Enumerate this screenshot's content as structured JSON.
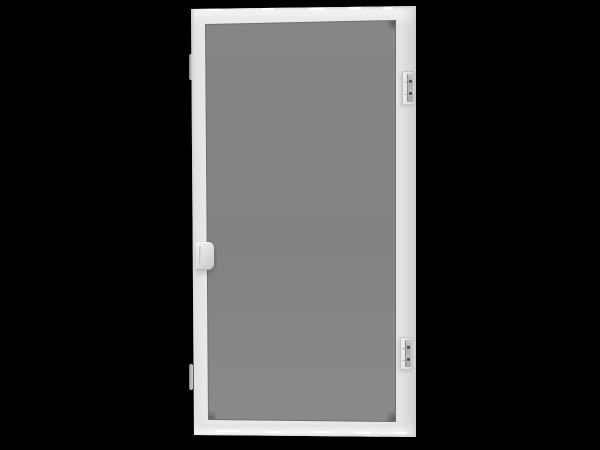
{
  "scene": {
    "type": "product-photo",
    "background_color": "#000000",
    "product": {
      "name": "White frame window screen with gray mesh",
      "frame_color": "#ececec",
      "frame_shadow_color": "#cccccc",
      "mesh_color": "#858585",
      "mesh_groove_color": "#6f6f6f",
      "hardware_color": "#dedede",
      "screw_color": "#4c4c4c",
      "parts": {
        "frame": "extruded screen frame",
        "mesh": "screen mesh cloth",
        "handle": "pull-tab handle, center of left rail",
        "latch_top": "plunger latch, upper right rail",
        "latch_bottom": "plunger latch, lower right rail",
        "clip_top": "spring clip, upper left edge",
        "clip_bottom": "spring clip, lower left edge"
      }
    }
  }
}
